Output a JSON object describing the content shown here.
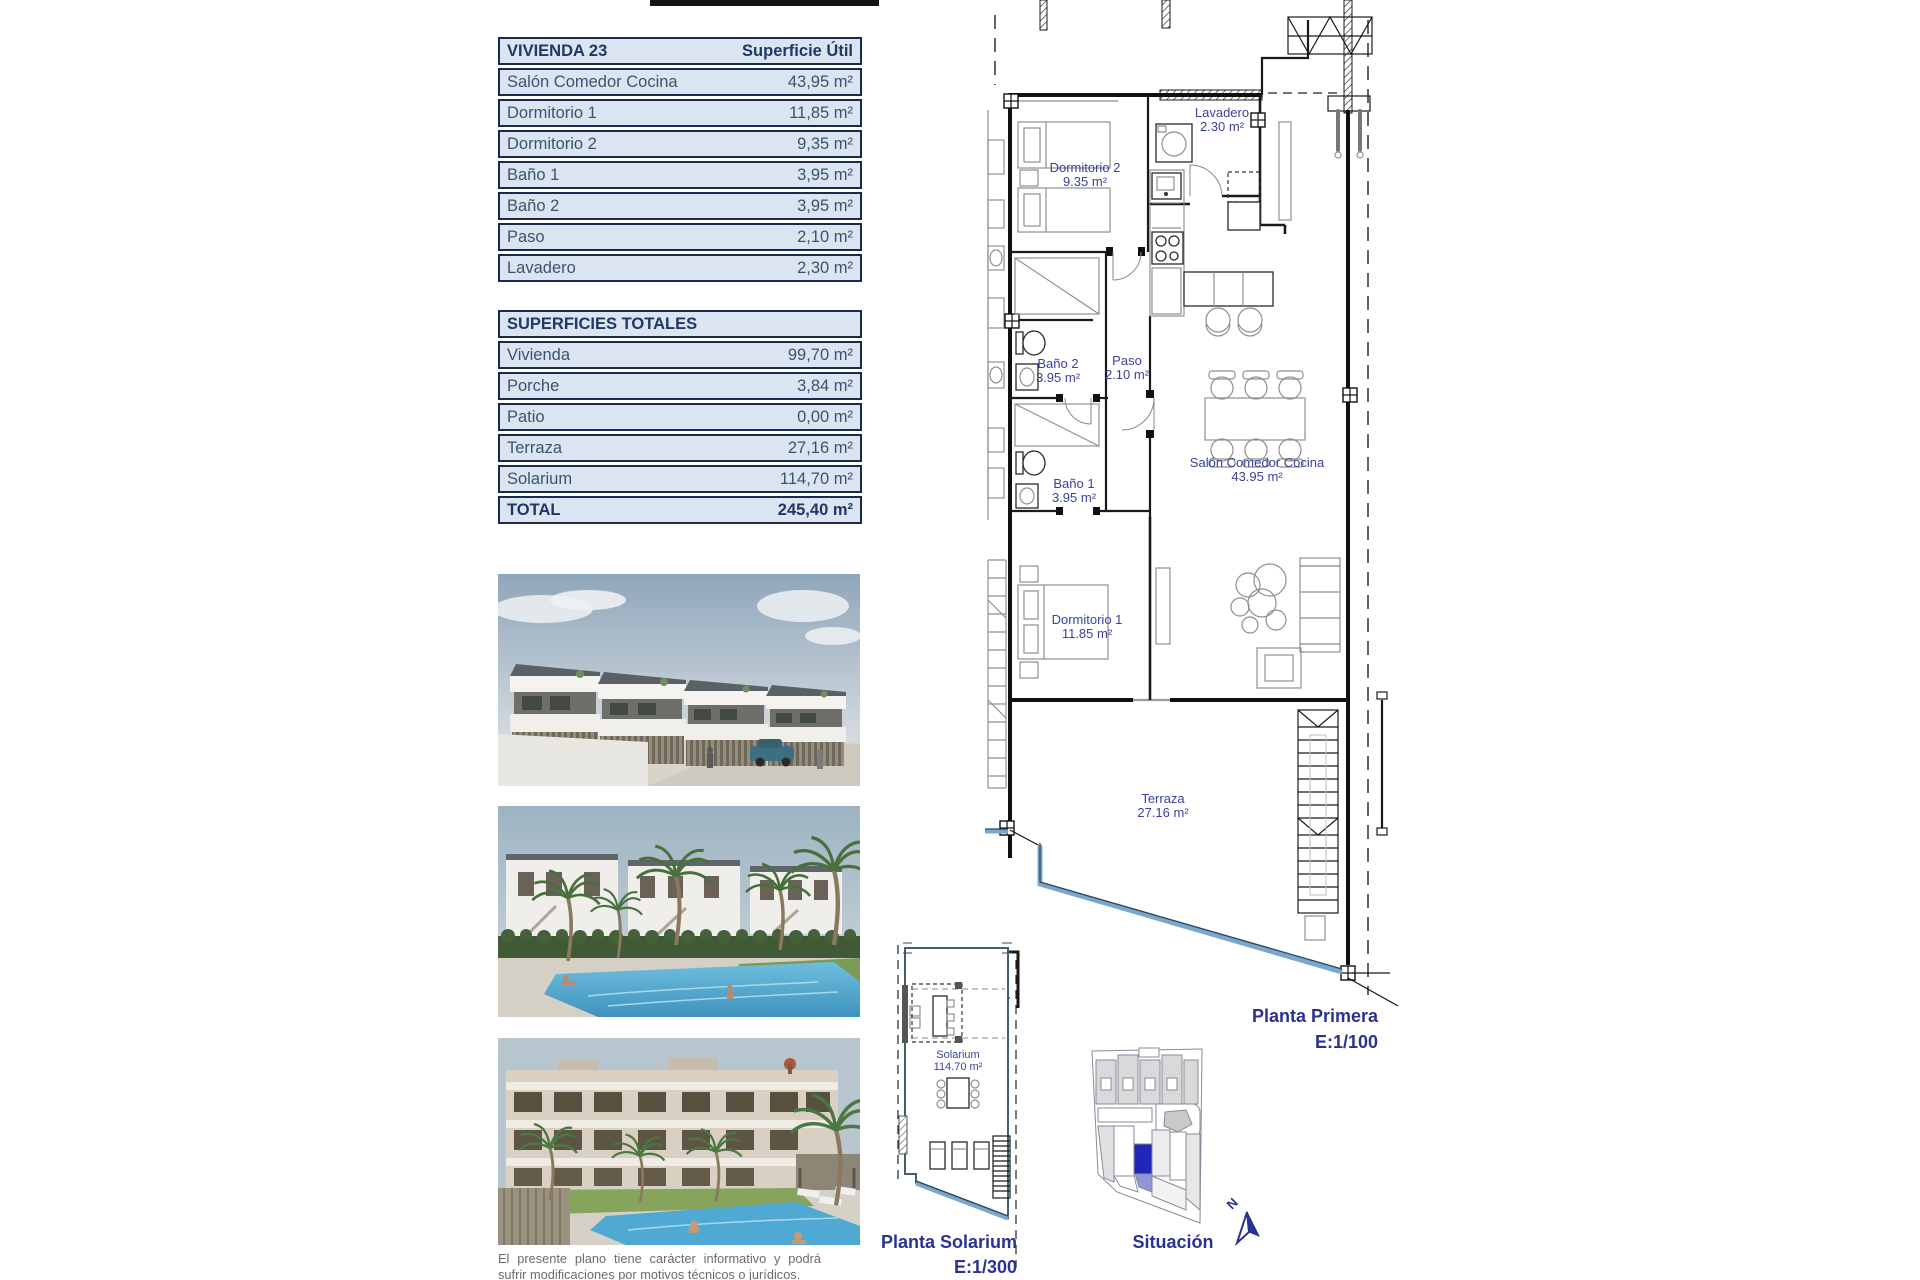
{
  "unit_table": {
    "title": "VIVIENDA 23",
    "header_value": "Superficie Útil",
    "rows": [
      {
        "label": "Salón Comedor Cocina",
        "value": "43,95 m²"
      },
      {
        "label": "Dormitorio 1",
        "value": "11,85 m²"
      },
      {
        "label": "Dormitorio 2",
        "value": "9,35 m²"
      },
      {
        "label": "Baño 1",
        "value": "3,95 m²"
      },
      {
        "label": "Baño 2",
        "value": "3,95 m²"
      },
      {
        "label": "Paso",
        "value": "2,10 m²"
      },
      {
        "label": "Lavadero",
        "value": "2,30 m²"
      }
    ]
  },
  "totals_table": {
    "title": "SUPERFICIES TOTALES",
    "rows": [
      {
        "label": "Vivienda",
        "value": "99,70 m²"
      },
      {
        "label": "Porche",
        "value": "3,84 m²"
      },
      {
        "label": "Patio",
        "value": "0,00 m²"
      },
      {
        "label": "Terraza",
        "value": "27,16 m²"
      },
      {
        "label": "Solarium",
        "value": "114,70 m²"
      }
    ],
    "total": {
      "label": "TOTAL",
      "value": "245,40 m²"
    }
  },
  "floor_plan": {
    "rooms": {
      "lavadero": {
        "name": "Lavadero",
        "area": "2.30 m²"
      },
      "dormitorio2": {
        "name": "Dormitorio 2",
        "area": "9.35 m²"
      },
      "bano2": {
        "name": "Baño 2",
        "area": "3.95 m²"
      },
      "paso": {
        "name": "Paso",
        "area": "2.10 m²"
      },
      "bano1": {
        "name": "Baño 1",
        "area": "3.95 m²"
      },
      "salon": {
        "name": "Salón Comedor Cocina",
        "area": "43.95 m²"
      },
      "dormitorio1": {
        "name": "Dormitorio 1",
        "area": "11.85 m²"
      },
      "terraza": {
        "name": "Terraza",
        "area": "27.16 m²"
      }
    },
    "caption": {
      "line1": "Planta Primera",
      "line2": "E:1/100"
    }
  },
  "solarium_plan": {
    "room": {
      "name": "Solarium",
      "area": "114.70 m²"
    },
    "caption": {
      "line1": "Planta Solarium",
      "line2": "E:1/300"
    }
  },
  "site_plan": {
    "caption": "Situación",
    "north_label": "N"
  },
  "disclaimer": "El presente plano tiene carácter informativo y podrá sufrir modificaciones por motivos técnicos o jurídicos.",
  "colors": {
    "caption_blue": "#2b3192",
    "plan_label_blue": "#3a41a0",
    "table_bg": "#dbe5f1",
    "table_border": "#1b2a4a",
    "highlight_blue": "#2126b8",
    "water_blue": "#7aa7cc"
  }
}
